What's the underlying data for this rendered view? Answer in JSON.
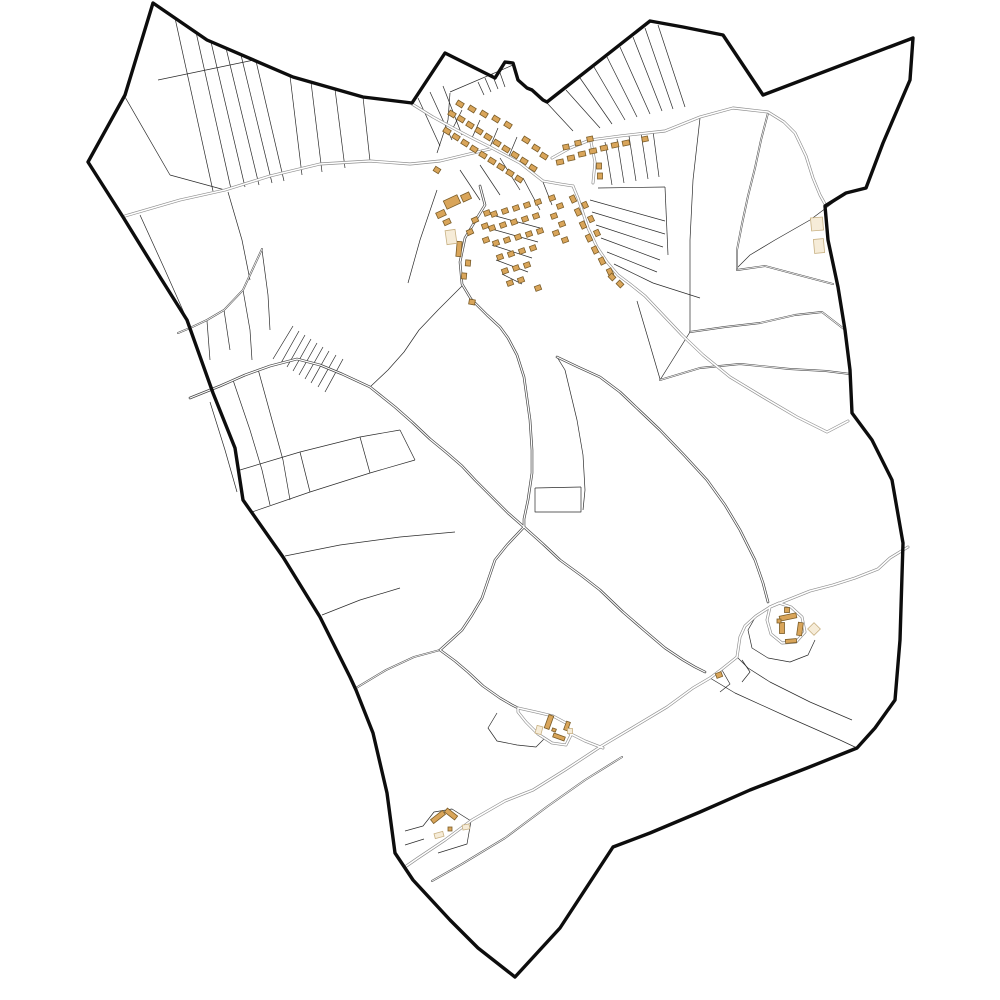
{
  "canvas": {
    "width": 1000,
    "height": 1000,
    "background": "#ffffff"
  },
  "map": {
    "type": "cadastral-commune-map",
    "colors": {
      "boundary": "#0d0d0d",
      "parcel_line": "#2b2b2b",
      "road_light_casing": "#8f8f8f",
      "road_dark_casing": "#474747",
      "track_casing": "#4d4d4d",
      "road_fill": "#ffffff",
      "building_fill": "#d9a55a",
      "building_stroke": "#7a5c28",
      "pale_building_fill": "#f6ecd8",
      "pale_building_stroke": "#c8b183"
    },
    "boundary_points": "153,3 125,95 88,162 123,217 160,277 187,320 213,393 235,448 243,500 283,557 320,617 350,677 356,690 373,733 387,793 395,853 413,880 450,920 478,948 515,977 560,928 613,847 650,833 700,812 750,790 807,768 857,748 875,728 895,700 900,640 903,543 892,480 872,440 852,413 850,370 845,330 838,287 828,240 825,206 846,193 866,188 883,143 910,80 913,38 763,95 723,35 683,27 650,21 547,102 543,100 532,90 527,88 518,80 513,63 505,62 495,78 445,53 412,103 363,97 293,77 207,40",
    "roads_light": [
      "412,104 433,117 453,128 472,138 490,147 520,163 543,181 560,184 573,186",
      "125,216 180,200 225,190 270,176 320,164 370,161 410,164 440,161 465,155 490,149",
      "552,158 570,148 590,140 620,136 665,131 700,117 733,108 768,112 784,122 795,133 806,156 813,178 820,195 825,204",
      "591,142 595,162 593,183",
      "573,186 578,198 582,210 588,228 597,247 607,262 618,275 630,284 645,296 663,315 682,335 703,355 730,377 763,397 797,417 827,432 848,421",
      "908,547 890,558 878,569 855,578 833,585 810,591 790,599 770,607 756,616 745,626 740,637 737,657 722,669 710,678 693,688 667,707 632,728 600,747 565,770 533,790 505,801 472,820 445,840 418,858 405,867",
      "770,607 767,620 771,634 782,643 796,642 805,632 802,617 791,607 779,603 770,607",
      "518,708 536,712 553,716 566,723 571,735 566,745 552,743 538,734 526,722 518,712 518,708",
      "569,733 585,741 603,748"
    ],
    "roads_dark": [
      "190,398 220,386 245,375 270,366 297,359 320,365 342,374 370,387 395,407 412,422 430,439 447,453 462,466 475,480 492,497 508,513 524,527",
      "480,186 485,205 477,218 465,238 460,262 462,284 471,299 487,315 500,327 508,338 517,355 524,377 530,420 532,450 532,473 528,500 524,519 524,527",
      "524,527 543,544 560,560 582,576 600,590 623,612 645,631 665,648 683,660 695,667 705,672",
      "524,527 507,545 495,560 482,598 472,615 462,630 450,641 440,650 455,661 468,672 483,686 500,698 512,705 518,708",
      "557,357 578,367 600,377 620,392 640,411 660,430 684,455 707,480 725,505 740,530 755,560 763,583 768,602"
    ],
    "tracks": [
      "262,249 243,290 224,310 207,320 190,328 178,333",
      "768,113 761,140 755,168 748,196 742,224 737,250 737,268",
      "737,270 765,266 795,274 833,284",
      "690,332 725,327 760,323 795,315 822,312 844,329",
      "660,380 700,368 740,364 790,369 826,371 850,374",
      "356,688 386,670 414,657 440,650",
      "622,757 585,780 548,806 505,838 462,864 432,881"
    ],
    "parcel_lines": [
      "175,18 213,191",
      "196,32 231,189",
      "211,42 245,187",
      "226,48 259,185",
      "241,55 272,183",
      "256,61 284,181",
      "158,80 254,60",
      "125,97 170,175",
      "170,175 225,190",
      "290,76 302,175",
      "311,82 322,172",
      "335,89 345,168",
      "363,97 370,161",
      "418,98 440,146",
      "430,92 452,140",
      "443,86 462,135",
      "450,92 513,65",
      "478,82 484,95",
      "485,78 491,92",
      "492,74 498,89",
      "499,70 505,87",
      "437,153 448,120 450,93",
      "566,90 600,128",
      "580,78 612,124",
      "594,67 625,120",
      "607,57 637,117",
      "620,47 650,114",
      "633,37 662,111",
      "645,28 673,109",
      "658,25 685,107",
      "547,103 573,131",
      "605,142 612,185",
      "617,139 624,183",
      "629,136 636,181",
      "641,133 648,179",
      "653,131 659,177",
      "598,188 665,187",
      "590,200 665,221",
      "592,212 665,234",
      "596,225 663,247",
      "601,238 660,260",
      "607,252 657,272",
      "614,264 653,283",
      "665,187 668,255",
      "653,283 700,298",
      "700,118 693,180 690,240 690,332",
      "846,193 810,220 775,240 750,255 737,268",
      "690,332 660,380",
      "557,357 565,370 577,420 583,455 585,490 583,510",
      "535,488 581,487",
      "581,487 581,512 558,512",
      "535,488 535,512 558,512",
      "637,301 650,345 660,379",
      "463,285 438,310 419,330 404,352 388,370 370,387",
      "437,190 420,240 408,283",
      "453,128 462,110",
      "472,138 480,120",
      "490,147 498,128",
      "509,156 517,137",
      "460,170 480,200",
      "480,165 500,195",
      "500,158 520,190",
      "523,178 540,210",
      "543,182 552,205",
      "492,215 540,228",
      "488,228 538,242",
      "492,245 532,258",
      "496,260 528,272",
      "502,274 522,284",
      "262,250 268,295 270,330",
      "243,290 250,330 252,360",
      "224,310 230,350",
      "207,321 210,360",
      "140,215 165,270 185,315",
      "228,192 242,240 250,280",
      "299,331 281,363",
      "305,335 287,367",
      "311,339 293,371",
      "317,343 299,375",
      "323,347 305,379",
      "329,351 311,383",
      "336,355 318,387",
      "293,326 273,359",
      "343,359 325,392",
      "210,402 225,450 237,492",
      "233,380 250,430 262,470 270,505",
      "258,369 272,420 283,460 290,500",
      "240,470 300,452 360,437 400,430",
      "252,512 310,492 370,473 415,460",
      "300,452 310,492",
      "360,437 370,473",
      "400,430 415,460",
      "285,556 340,545 400,537 455,532",
      "322,615 360,600 400,588",
      "497,713 488,728 497,741 517,745 536,747 545,738",
      "756,616 748,630 752,648 768,658 790,662 808,655 815,640",
      "742,660 750,672 742,682",
      "722,670 730,684 720,692",
      "710,678 735,693 790,718 840,740 857,748",
      "737,657 748,668 770,682 810,702 852,720",
      "405,831 423,826 434,812 452,809 471,821 467,844 438,853",
      "405,845 424,839"
    ],
    "buildings": [
      [
        452,
        114,
        7,
        5,
        32
      ],
      [
        461,
        119,
        7,
        5,
        32
      ],
      [
        470,
        125,
        7,
        5,
        32
      ],
      [
        479,
        131,
        7,
        5,
        32
      ],
      [
        488,
        137,
        7,
        5,
        32
      ],
      [
        497,
        143,
        7,
        5,
        32
      ],
      [
        506,
        149,
        7,
        5,
        32
      ],
      [
        515,
        155,
        7,
        5,
        32
      ],
      [
        524,
        161,
        7,
        5,
        32
      ],
      [
        533,
        168,
        7,
        5,
        32
      ],
      [
        447,
        131,
        7,
        5,
        32
      ],
      [
        456,
        137,
        7,
        5,
        32
      ],
      [
        465,
        143,
        7,
        5,
        32
      ],
      [
        474,
        149,
        7,
        5,
        32
      ],
      [
        483,
        155,
        7,
        5,
        32
      ],
      [
        492,
        161,
        7,
        5,
        32
      ],
      [
        501,
        167,
        7,
        5,
        32
      ],
      [
        510,
        173,
        7,
        5,
        32
      ],
      [
        519,
        179,
        7,
        5,
        32
      ],
      [
        460,
        104,
        7,
        5,
        32
      ],
      [
        472,
        109,
        7,
        5,
        32
      ],
      [
        484,
        114,
        7,
        5,
        32
      ],
      [
        496,
        119,
        7,
        5,
        32
      ],
      [
        508,
        125,
        7,
        5,
        32
      ],
      [
        526,
        140,
        7,
        5,
        32
      ],
      [
        536,
        148,
        7,
        5,
        32
      ],
      [
        544,
        156,
        7,
        5,
        32
      ],
      [
        560,
        162,
        7,
        5,
        -12
      ],
      [
        571,
        158,
        7,
        5,
        -12
      ],
      [
        582,
        154,
        7,
        5,
        -12
      ],
      [
        593,
        151,
        7,
        5,
        -12
      ],
      [
        604,
        148,
        7,
        5,
        -12
      ],
      [
        615,
        145,
        7,
        5,
        -12
      ],
      [
        626,
        143,
        7,
        5,
        -12
      ],
      [
        566,
        147,
        6,
        5,
        -12
      ],
      [
        578,
        143,
        6,
        5,
        -12
      ],
      [
        590,
        139,
        6,
        5,
        -12
      ],
      [
        645,
        139,
        6,
        5,
        -12
      ],
      [
        599,
        166,
        5,
        6,
        0
      ],
      [
        600,
        176,
        5,
        6,
        0
      ],
      [
        573,
        199,
        7,
        5,
        65
      ],
      [
        578,
        212,
        7,
        5,
        65
      ],
      [
        583,
        225,
        7,
        5,
        65
      ],
      [
        589,
        238,
        7,
        5,
        65
      ],
      [
        595,
        250,
        7,
        5,
        65
      ],
      [
        602,
        261,
        7,
        5,
        65
      ],
      [
        610,
        272,
        7,
        5,
        65
      ],
      [
        585,
        205,
        6,
        5,
        65
      ],
      [
        591,
        219,
        6,
        5,
        65
      ],
      [
        597,
        233,
        6,
        5,
        65
      ],
      [
        612,
        277,
        6,
        5,
        45
      ],
      [
        620,
        284,
        6,
        5,
        45
      ],
      [
        452,
        202,
        15,
        9,
        -25
      ],
      [
        466,
        197,
        9,
        7,
        -25
      ],
      [
        441,
        214,
        9,
        6,
        -25
      ],
      [
        447,
        222,
        7,
        5,
        -25
      ],
      [
        459,
        249,
        5,
        15,
        5
      ],
      [
        470,
        232,
        6,
        5,
        -25
      ],
      [
        475,
        220,
        6,
        5,
        -25
      ],
      [
        487,
        213,
        6,
        5,
        -20
      ],
      [
        485,
        226,
        6,
        5,
        -20
      ],
      [
        486,
        240,
        6,
        5,
        -20
      ],
      [
        494,
        214,
        6,
        5,
        -20
      ],
      [
        505,
        211,
        6,
        5,
        -20
      ],
      [
        516,
        208,
        6,
        5,
        -20
      ],
      [
        527,
        205,
        6,
        5,
        -20
      ],
      [
        538,
        202,
        6,
        5,
        -20
      ],
      [
        492,
        228,
        6,
        5,
        -20
      ],
      [
        503,
        225,
        6,
        5,
        -20
      ],
      [
        514,
        222,
        6,
        5,
        -20
      ],
      [
        525,
        219,
        6,
        5,
        -20
      ],
      [
        536,
        216,
        6,
        5,
        -20
      ],
      [
        496,
        243,
        6,
        5,
        -20
      ],
      [
        507,
        240,
        6,
        5,
        -20
      ],
      [
        518,
        237,
        6,
        5,
        -20
      ],
      [
        529,
        234,
        6,
        5,
        -20
      ],
      [
        540,
        231,
        6,
        5,
        -20
      ],
      [
        500,
        257,
        6,
        5,
        -20
      ],
      [
        511,
        254,
        6,
        5,
        -20
      ],
      [
        522,
        251,
        6,
        5,
        -20
      ],
      [
        533,
        248,
        6,
        5,
        -20
      ],
      [
        505,
        271,
        6,
        5,
        -20
      ],
      [
        516,
        268,
        6,
        5,
        -20
      ],
      [
        527,
        265,
        6,
        5,
        -20
      ],
      [
        510,
        283,
        6,
        5,
        -20
      ],
      [
        521,
        280,
        6,
        5,
        -20
      ],
      [
        538,
        288,
        6,
        5,
        -20
      ],
      [
        552,
        198,
        6,
        5,
        -20
      ],
      [
        560,
        206,
        6,
        5,
        -20
      ],
      [
        554,
        216,
        6,
        5,
        -20
      ],
      [
        562,
        224,
        6,
        5,
        -20
      ],
      [
        556,
        233,
        6,
        5,
        -20
      ],
      [
        565,
        240,
        6,
        5,
        -20
      ],
      [
        437,
        170,
        6,
        5,
        32
      ],
      [
        468,
        263,
        5,
        6,
        5
      ],
      [
        464,
        276,
        5,
        6,
        5
      ],
      [
        472,
        302,
        6,
        5,
        10
      ],
      [
        788,
        617,
        17,
        5,
        -12
      ],
      [
        782,
        628,
        5,
        11,
        0
      ],
      [
        800,
        629,
        5,
        13,
        8
      ],
      [
        791,
        641,
        11,
        4,
        -5
      ],
      [
        787,
        610,
        5,
        5,
        0
      ],
      [
        779,
        621,
        4,
        4,
        0
      ],
      [
        719,
        675,
        6,
        5,
        -20
      ],
      [
        549,
        722,
        5,
        14,
        20
      ],
      [
        559,
        737,
        12,
        4,
        20
      ],
      [
        567,
        726,
        4,
        9,
        20
      ],
      [
        554,
        730,
        4,
        3,
        20
      ],
      [
        438,
        817,
        15,
        5,
        -38
      ],
      [
        451,
        814,
        13,
        5,
        38
      ],
      [
        450,
        829,
        4,
        4,
        0
      ]
    ],
    "pale_buildings": [
      [
        817,
        224,
        12,
        13,
        -5
      ],
      [
        819,
        246,
        10,
        14,
        -5
      ],
      [
        814,
        629,
        9,
        9,
        45
      ],
      [
        451,
        237,
        10,
        14,
        -8
      ],
      [
        539,
        730,
        6,
        8,
        15
      ],
      [
        570,
        731,
        5,
        5,
        0
      ],
      [
        439,
        835,
        9,
        5,
        -15
      ],
      [
        466,
        827,
        7,
        5,
        -10
      ]
    ]
  }
}
